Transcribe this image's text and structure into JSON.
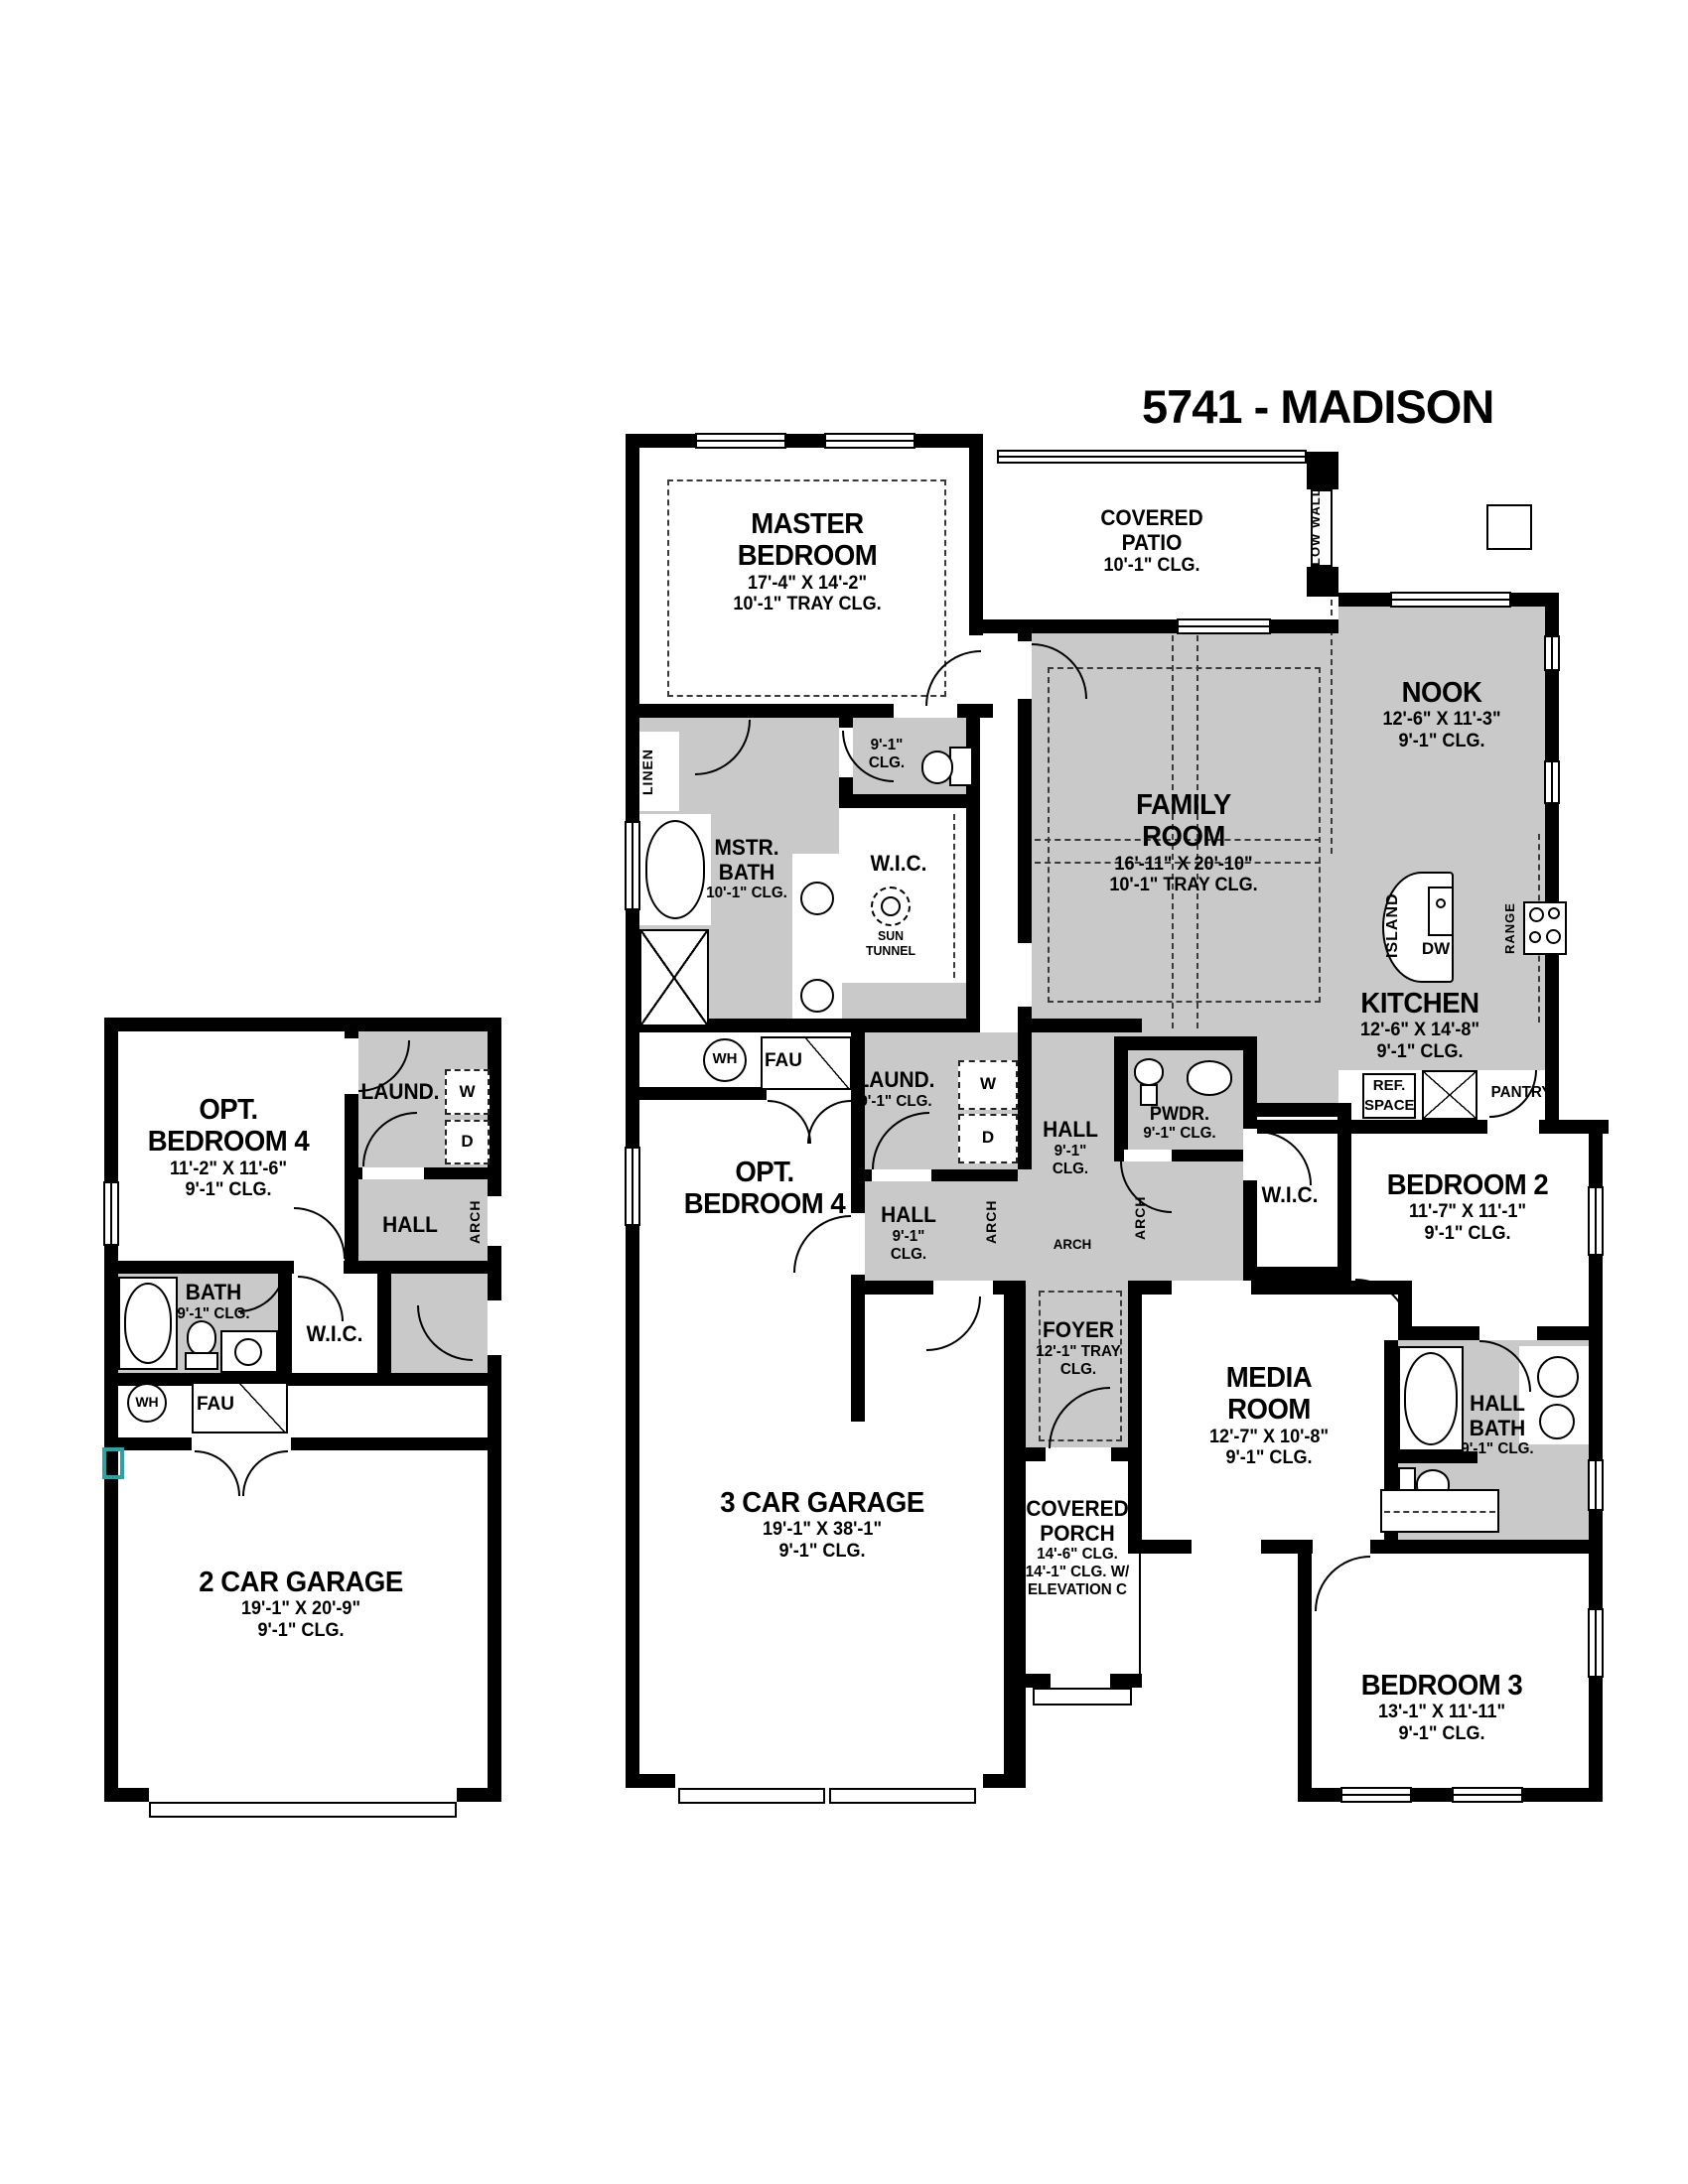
{
  "title": "5741 - MADISON",
  "colors": {
    "zone_gray": "#c9c9c9",
    "wall_black": "#000000",
    "accent_teal": "#2ba3a3",
    "background": "#ffffff"
  },
  "main": {
    "master": {
      "l1": "MASTER",
      "l2": "BEDROOM",
      "dims": "17'-4\" X 14'-2\"",
      "clg": "10'-1\" TRAY CLG."
    },
    "patio": {
      "l1": "COVERED",
      "l2": "PATIO",
      "clg": "10'-1\" CLG."
    },
    "low_wall": "LOW WALL",
    "nook": {
      "l1": "NOOK",
      "dims": "12'-6\" X 11'-3\"",
      "clg": "9'-1\" CLG."
    },
    "family": {
      "l1": "FAMILY",
      "l2": "ROOM",
      "dims": "16'-11\" X 20'-10\"",
      "clg": "10'-1\" TRAY CLG."
    },
    "kitchen": {
      "l1": "KITCHEN",
      "dims": "12'-6\" X 14'-8\"",
      "clg": "9'-1\" CLG."
    },
    "island": "ISLAND",
    "dw": "DW",
    "range": "RANGE",
    "ref1": "REF.",
    "ref2": "SPACE",
    "pantry": "PANTRY",
    "linen": "LINEN",
    "mstr_bath": {
      "l1": "MSTR.",
      "l2": "BATH",
      "clg": "10'-1\" CLG."
    },
    "wc": {
      "l1": "9'-1\"",
      "l2": "CLG."
    },
    "wic": {
      "l1": "W.I.C.",
      "s1": "SUN",
      "s2": "TUNNEL"
    },
    "laund": {
      "l1": "LAUND.",
      "clg": "9'-1\" CLG.",
      "w": "W",
      "d": "D"
    },
    "hall_c": {
      "l1": "HALL",
      "l2": "9'-1\"",
      "l3": "CLG."
    },
    "hall_e": {
      "l1": "HALL",
      "l2": "9'-1\"",
      "l3": "CLG."
    },
    "arch": "ARCH",
    "pwdr": {
      "l1": "PWDR.",
      "clg": "9'-1\" CLG."
    },
    "wic2": "W.I.C.",
    "bed2": {
      "l1": "BEDROOM 2",
      "dims": "11'-7\" X 11'-1\"",
      "clg": "9'-1\" CLG."
    },
    "media": {
      "l1": "MEDIA",
      "l2": "ROOM",
      "dims": "12'-7\" X 10'-8\"",
      "clg": "9'-1\" CLG."
    },
    "hall_bath": {
      "l1": "HALL",
      "l2": "BATH",
      "clg": "9'-1\" CLG."
    },
    "bed3": {
      "l1": "BEDROOM 3",
      "dims": "13'-1\" X 11'-11\"",
      "clg": "9'-1\" CLG."
    },
    "foyer": {
      "l1": "FOYER",
      "l2": "12'-1\" TRAY",
      "l3": "CLG."
    },
    "porch": {
      "l1": "COVERED",
      "l2": "PORCH",
      "l3": "14'-6\" CLG.",
      "l4": "14'-1\" CLG. W/",
      "l5": "ELEVATION C"
    },
    "optbed4": {
      "l1": "OPT.",
      "l2": "BEDROOM 4"
    },
    "wh": "WH",
    "fau": "FAU",
    "garage": {
      "l1": "3 CAR GARAGE",
      "dims": "19'-1\" X 38'-1\"",
      "clg": "9'-1\" CLG."
    }
  },
  "left": {
    "optbed4": {
      "l1": "OPT.",
      "l2": "BEDROOM 4",
      "dims": "11'-2\" X 11'-6\"",
      "clg": "9'-1\" CLG."
    },
    "laund": "LAUND.",
    "w": "W",
    "d": "D",
    "hall": "HALL",
    "arch": "ARCH",
    "bath": {
      "l1": "BATH",
      "clg": "9'-1\" CLG."
    },
    "wic": "W.I.C.",
    "wh": "WH",
    "fau": "FAU",
    "garage": {
      "l1": "2 CAR GARAGE",
      "dims": "19'-1\" X 20'-9\"",
      "clg": "9'-1\" CLG."
    }
  }
}
